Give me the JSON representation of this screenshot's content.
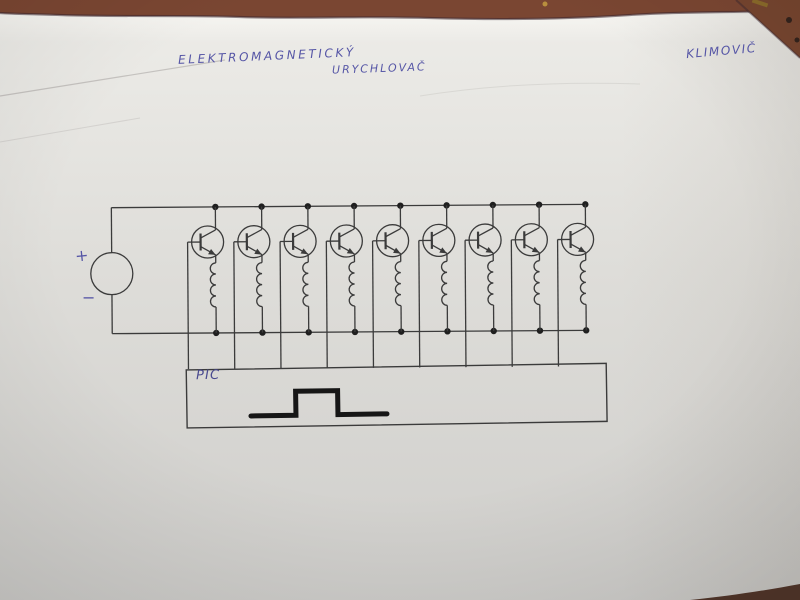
{
  "photo": {
    "description": "hand-drawn electromagnetic accelerator schematic on a sheet of paper photographed on a brown table",
    "table_color": "#7a4632",
    "paper_color_top": "#edecе8",
    "paper_color_bottom": "#d0cfcc"
  },
  "title": {
    "line1": "ELEKTROMAGNETICKÝ",
    "line2": "URYCHLOVAČ"
  },
  "author": "KLIMOVIČ",
  "power_source": {
    "plus_label": "+",
    "minus_label": "−"
  },
  "controller": {
    "label": "PIC",
    "waveform": "single rectangular pulse"
  },
  "circuit": {
    "stage_count": 9,
    "stage_components": [
      "NPN transistor",
      "coil (inductor)"
    ],
    "topology": "nine parallel transistor+coil stages between two supply rails, bases fed from PIC box",
    "ink_color": "#3b3b3b",
    "dot_color": "#1f1f1f",
    "handwriting_color": "#5656a6",
    "handwriting_dark": "#4a4a8f",
    "pulse_color": "#161616"
  }
}
